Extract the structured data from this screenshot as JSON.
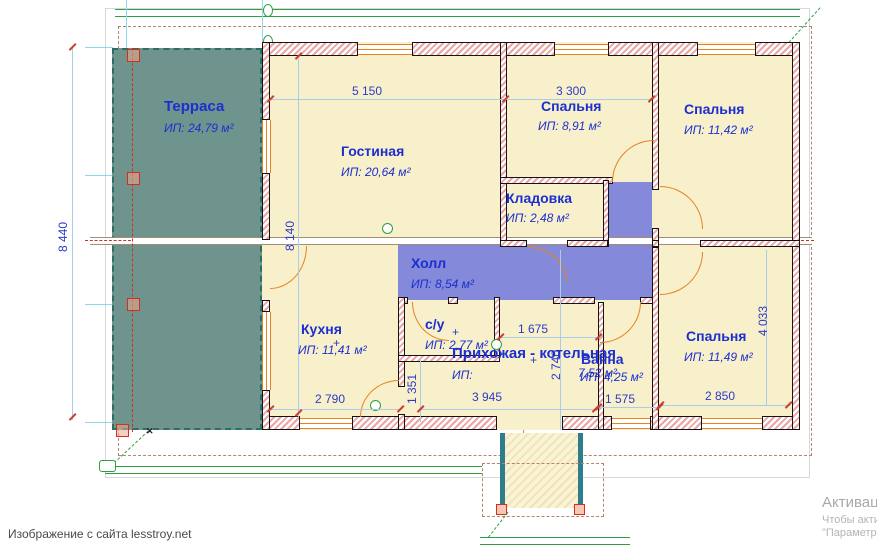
{
  "rooms": {
    "terrace": {
      "name": "Терраса",
      "area": "ИП: 24,79 м²"
    },
    "living": {
      "name": "Гостиная",
      "area": "ИП: 20,64 м²"
    },
    "bedroom_top_mid": {
      "name": "Спальня",
      "area": "ИП: 8,91 м²"
    },
    "bedroom_top_right": {
      "name": "Спальня",
      "area": "ИП: 11,42 м²"
    },
    "storage": {
      "name": "Кладовка",
      "area": "ИП:  2,48 м²"
    },
    "hall": {
      "name": "Холл",
      "area": "ИП: 8,54 м²"
    },
    "kitchen": {
      "name": "Кухня",
      "area": "ИП: 11,41 м²"
    },
    "wc": {
      "name": "с/у",
      "area": "ИП: 2,77 м²"
    },
    "entry_boiler": {
      "name": "Прихожая - котельная",
      "area_label": "ИП:",
      "area_value": "7,52 м²"
    },
    "bath": {
      "name": "Ванна",
      "area": "ИП: 4,25 м²"
    },
    "bedroom_bot_right": {
      "name": "Спальня",
      "area": "ИП: 11,49 м²"
    }
  },
  "dimensions": {
    "total_depth": "8 440",
    "inner_depth": "8 140",
    "living_width": "5 150",
    "bedroom_mid_width": "3 300",
    "kitchen_width": "2 790",
    "entry_offset": "1 351",
    "entry_width": "3 945",
    "corridor_width": "1 675",
    "corridor_depth": "2 740",
    "bath_width": "1 575",
    "bedroom_br_width": "2 850",
    "bedroom_br_depth": "4 033"
  },
  "footer": {
    "caption": "Изображение с сайта lesstroy.net"
  },
  "watermark": {
    "line1": "Активац",
    "line2": "Чтобы акти",
    "line3": "\"Параметр"
  },
  "colors": {
    "wall_hatch": "#eda4a4",
    "terrace_fill": "#6f948d",
    "hall_fill": "#8589d9",
    "room_fill": "#f8efcb",
    "door_orange": "#e8821e",
    "dim_line": "#a9cce8",
    "dim_text": "#2b3bc8",
    "label_blue": "#1b2fd0",
    "axis_red": "#d03020",
    "green": "#2f9e40",
    "porch_teal": "#2e7d8c"
  }
}
